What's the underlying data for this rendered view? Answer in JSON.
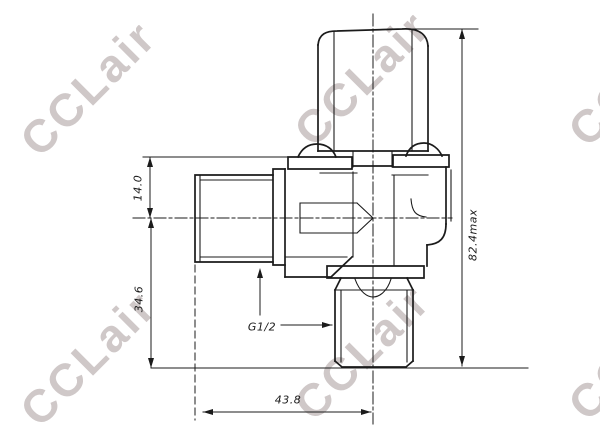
{
  "watermark": {
    "text": "CCLair",
    "color": "#cfc8c8"
  },
  "drawing": {
    "line_color": "#1b1b1b",
    "dimensions": {
      "bonnet_to_centerline": "14.0",
      "centerline_to_base": "34.6",
      "port_face_to_centerline": "43.8",
      "overall_height_max": "82.4max",
      "thread_size": "G1/2"
    }
  }
}
